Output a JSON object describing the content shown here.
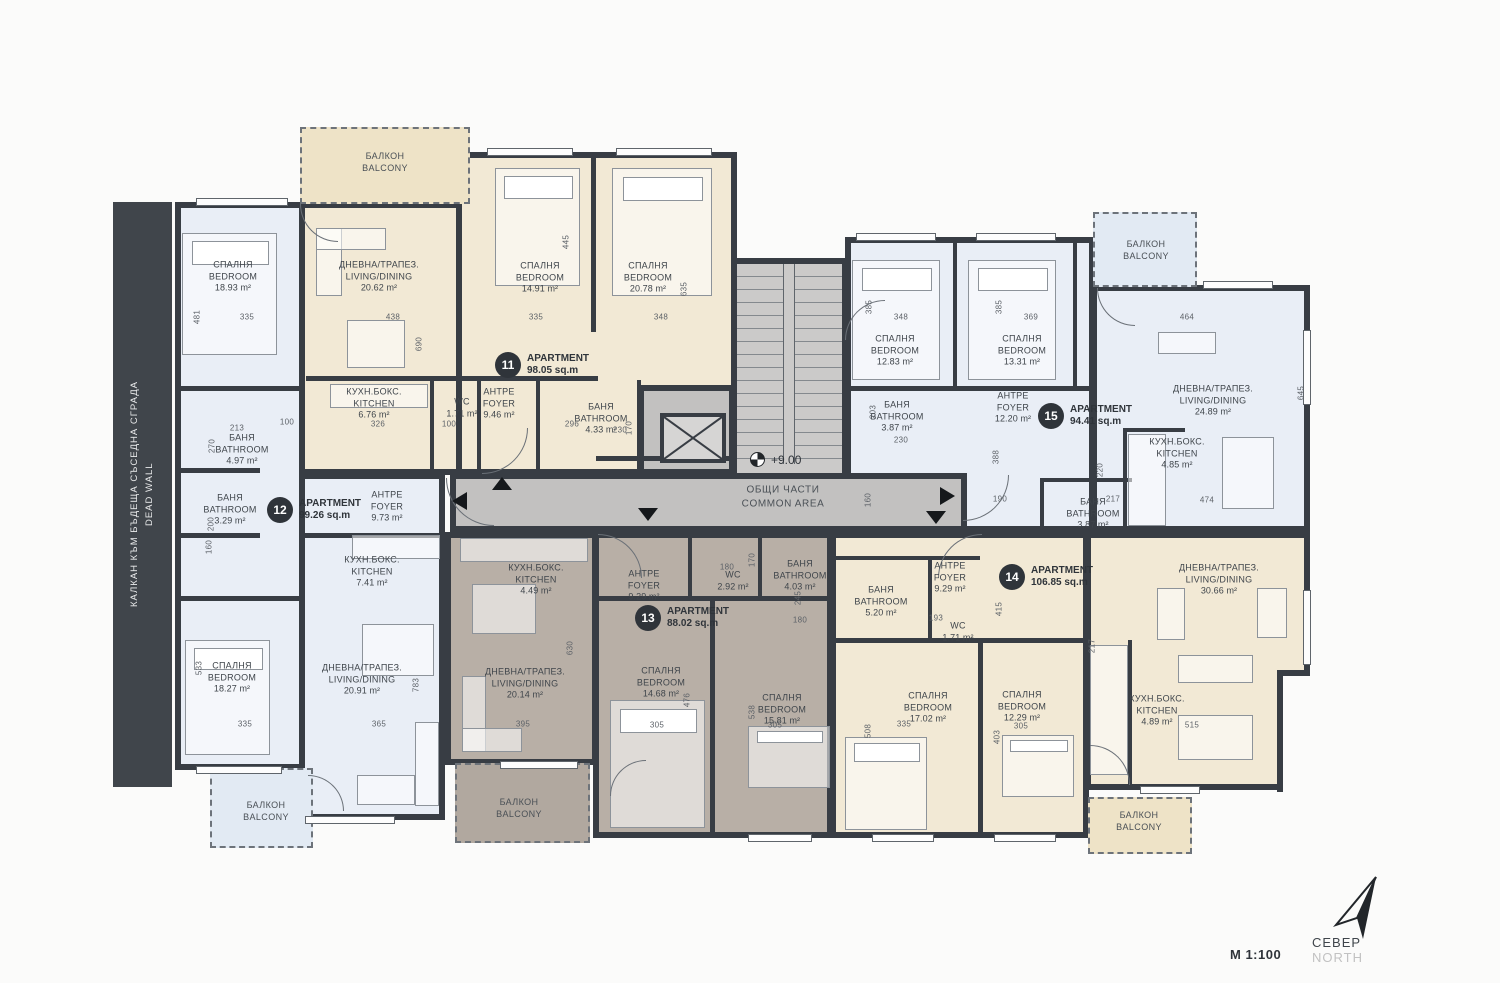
{
  "plan": {
    "scale": "М 1:100",
    "north": {
      "bg": "СЕВЕР",
      "en": "NORTH"
    },
    "level_mark": "+9.00",
    "dead_wall": {
      "bg": "КАЛКАН КЪМ БЪДЕЩА СЪСЕДНА СГРАДА",
      "en": "DEAD WALL"
    },
    "common_area": {
      "bg": "ОБЩИ ЧАСТИ",
      "en": "COMMON AREA"
    }
  },
  "balcony_label": {
    "bg": "БАЛКОН",
    "en": "BALCONY"
  },
  "apartments": [
    {
      "number": "11",
      "title": "APARTMENT",
      "area": "98.05 sq.m",
      "x": 508,
      "y": 365
    },
    {
      "number": "12",
      "title": "APARTMENT",
      "area": "99.26 sq.m",
      "x": 280,
      "y": 510
    },
    {
      "number": "13",
      "title": "APARTMENT",
      "area": "88.02 sq.m",
      "x": 648,
      "y": 618
    },
    {
      "number": "14",
      "title": "APARTMENT",
      "area": "106.85 sq.m",
      "x": 1012,
      "y": 577
    },
    {
      "number": "15",
      "title": "APARTMENT",
      "area": "94.41 sq.m",
      "x": 1051,
      "y": 416
    }
  ],
  "rooms": [
    {
      "apt": "12",
      "bg": "СПАЛНЯ",
      "en": "BEDROOM",
      "area": "18.93 m²",
      "x": 233,
      "y": 277
    },
    {
      "apt": "12",
      "bg": "БАНЯ",
      "en": "BATHROOM",
      "area": "4.97 m²",
      "x": 242,
      "y": 450
    },
    {
      "apt": "12",
      "bg": "БАНЯ",
      "en": "BATHROOM",
      "area": "3.29 m²",
      "x": 230,
      "y": 510
    },
    {
      "apt": "12",
      "bg": "АНТРЕ",
      "en": "FOYER",
      "area": "9.73 m²",
      "x": 387,
      "y": 507
    },
    {
      "apt": "12",
      "bg": "КУХН.БОКС.",
      "en": "KITCHEN",
      "area": "7.41 m²",
      "x": 372,
      "y": 572
    },
    {
      "apt": "12",
      "bg": "ДНЕВНА/ТРАПЕЗ.",
      "en": "LIVING/DINING",
      "area": "20.91 m²",
      "x": 362,
      "y": 680
    },
    {
      "apt": "12",
      "bg": "СПАЛНЯ",
      "en": "BEDROOM",
      "area": "18.27 m²",
      "x": 232,
      "y": 678
    },
    {
      "apt": "11",
      "bg": "ДНЕВНА/ТРАПЕЗ.",
      "en": "LIVING/DINING",
      "area": "20.62 m²",
      "x": 379,
      "y": 277
    },
    {
      "apt": "11",
      "bg": "СПАЛНЯ",
      "en": "BEDROOM",
      "area": "14.91 m²",
      "x": 540,
      "y": 278
    },
    {
      "apt": "11",
      "bg": "СПАЛНЯ",
      "en": "BEDROOM",
      "area": "20.78 m²",
      "x": 648,
      "y": 278
    },
    {
      "apt": "11",
      "bg": "КУХН.БОКС.",
      "en": "KITCHEN",
      "area": "6.76 m²",
      "x": 374,
      "y": 404
    },
    {
      "apt": "11",
      "bg": "WC",
      "en": "",
      "area": "1.71 m²",
      "x": 462,
      "y": 408
    },
    {
      "apt": "11",
      "bg": "АНТРЕ",
      "en": "FOYER",
      "area": "9.46 m²",
      "x": 499,
      "y": 404
    },
    {
      "apt": "11",
      "bg": "БАНЯ",
      "en": "BATHROOM",
      "area": "4.33 m²",
      "x": 601,
      "y": 419
    },
    {
      "apt": "13",
      "bg": "КУХН.БОКС.",
      "en": "KITCHEN",
      "area": "4.49 m²",
      "x": 536,
      "y": 580
    },
    {
      "apt": "13",
      "bg": "АНТРЕ",
      "en": "FOYER",
      "area": "9.29 m²",
      "x": 644,
      "y": 586
    },
    {
      "apt": "13",
      "bg": "WC",
      "en": "",
      "area": "2.92 m²",
      "x": 733,
      "y": 581
    },
    {
      "apt": "13",
      "bg": "БАНЯ",
      "en": "BATHROOM",
      "area": "4.03 m²",
      "x": 800,
      "y": 576
    },
    {
      "apt": "13",
      "bg": "ДНЕВНА/ТРАПЕЗ.",
      "en": "LIVING/DINING",
      "area": "20.14 m²",
      "x": 525,
      "y": 684
    },
    {
      "apt": "13",
      "bg": "СПАЛНЯ",
      "en": "BEDROOM",
      "area": "14.68 m²",
      "x": 661,
      "y": 683
    },
    {
      "apt": "13",
      "bg": "СПАЛНЯ",
      "en": "BEDROOM",
      "area": "15.81 m²",
      "x": 782,
      "y": 710
    },
    {
      "apt": "14",
      "bg": "АНТРЕ",
      "en": "FOYER",
      "area": "9.29 m²",
      "x": 950,
      "y": 578
    },
    {
      "apt": "14",
      "bg": "БАНЯ",
      "en": "BATHROOM",
      "area": "5.20 m²",
      "x": 881,
      "y": 602
    },
    {
      "apt": "14",
      "bg": "WC",
      "en": "",
      "area": "1.71 m²",
      "x": 958,
      "y": 632
    },
    {
      "apt": "14",
      "bg": "СПАЛНЯ",
      "en": "BEDROOM",
      "area": "17.02 m²",
      "x": 928,
      "y": 708
    },
    {
      "apt": "14",
      "bg": "СПАЛНЯ",
      "en": "BEDROOM",
      "area": "12.29 m²",
      "x": 1022,
      "y": 707
    },
    {
      "apt": "14",
      "bg": "КУХН.БОКС.",
      "en": "KITCHEN",
      "area": "4.89 m²",
      "x": 1157,
      "y": 711
    },
    {
      "apt": "14",
      "bg": "ДНЕВНА/ТРАПЕЗ.",
      "en": "LIVING/DINING",
      "area": "30.66 m²",
      "x": 1219,
      "y": 580
    },
    {
      "apt": "15",
      "bg": "СПАЛНЯ",
      "en": "BEDROOM",
      "area": "12.83 m²",
      "x": 895,
      "y": 351
    },
    {
      "apt": "15",
      "bg": "СПАЛНЯ",
      "en": "BEDROOM",
      "area": "13.31 m²",
      "x": 1022,
      "y": 351
    },
    {
      "apt": "15",
      "bg": "БАНЯ",
      "en": "BATHROOM",
      "area": "3.87 m²",
      "x": 897,
      "y": 417
    },
    {
      "apt": "15",
      "bg": "АНТРЕ",
      "en": "FOYER",
      "area": "12.20 m²",
      "x": 1013,
      "y": 408
    },
    {
      "apt": "15",
      "bg": "ДНЕВНА/ТРАПЕЗ.",
      "en": "LIVING/DINING",
      "area": "24.89 m²",
      "x": 1213,
      "y": 401
    },
    {
      "apt": "15",
      "bg": "КУХН.БОКС.",
      "en": "KITCHEN",
      "area": "4.85 m²",
      "x": 1177,
      "y": 454
    },
    {
      "apt": "15",
      "bg": "БАНЯ",
      "en": "BATHROOM",
      "area": "3.87 m²",
      "x": 1093,
      "y": 514
    }
  ],
  "balconies": [
    {
      "x": 385,
      "y": 162
    },
    {
      "x": 1146,
      "y": 250
    },
    {
      "x": 266,
      "y": 811
    },
    {
      "x": 519,
      "y": 808
    },
    {
      "x": 1139,
      "y": 821
    }
  ],
  "dimensions": [
    {
      "t": "481",
      "x": 197,
      "y": 317,
      "r": 1
    },
    {
      "t": "335",
      "x": 247,
      "y": 317,
      "r": 0
    },
    {
      "t": "438",
      "x": 393,
      "y": 317,
      "r": 0
    },
    {
      "t": "690",
      "x": 419,
      "y": 344,
      "r": 1
    },
    {
      "t": "445",
      "x": 566,
      "y": 242,
      "r": 1
    },
    {
      "t": "335",
      "x": 536,
      "y": 317,
      "r": 0
    },
    {
      "t": "348",
      "x": 661,
      "y": 317,
      "r": 0
    },
    {
      "t": "635",
      "x": 684,
      "y": 289,
      "r": 1
    },
    {
      "t": "348",
      "x": 901,
      "y": 317,
      "r": 0
    },
    {
      "t": "385",
      "x": 869,
      "y": 307,
      "r": 1
    },
    {
      "t": "369",
      "x": 1031,
      "y": 317,
      "r": 0
    },
    {
      "t": "385",
      "x": 999,
      "y": 307,
      "r": 1
    },
    {
      "t": "464",
      "x": 1187,
      "y": 317,
      "r": 0
    },
    {
      "t": "645",
      "x": 1301,
      "y": 393,
      "r": 1
    },
    {
      "t": "213",
      "x": 237,
      "y": 428,
      "r": 0
    },
    {
      "t": "100",
      "x": 287,
      "y": 422,
      "r": 0
    },
    {
      "t": "270",
      "x": 212,
      "y": 446,
      "r": 1
    },
    {
      "t": "326",
      "x": 378,
      "y": 424,
      "r": 0
    },
    {
      "t": "100",
      "x": 449,
      "y": 424,
      "r": 0
    },
    {
      "t": "296",
      "x": 572,
      "y": 424,
      "r": 0
    },
    {
      "t": "170",
      "x": 629,
      "y": 428,
      "r": 1
    },
    {
      "t": "200",
      "x": 211,
      "y": 524,
      "r": 1
    },
    {
      "t": "160",
      "x": 209,
      "y": 547,
      "r": 1
    },
    {
      "t": "533",
      "x": 199,
      "y": 668,
      "r": 1
    },
    {
      "t": "783",
      "x": 416,
      "y": 685,
      "r": 1
    },
    {
      "t": "335",
      "x": 245,
      "y": 724,
      "r": 0
    },
    {
      "t": "365",
      "x": 379,
      "y": 724,
      "r": 0
    },
    {
      "t": "630",
      "x": 570,
      "y": 648,
      "r": 1
    },
    {
      "t": "395",
      "x": 523,
      "y": 724,
      "r": 0
    },
    {
      "t": "305",
      "x": 657,
      "y": 725,
      "r": 0
    },
    {
      "t": "476",
      "x": 687,
      "y": 700,
      "r": 1
    },
    {
      "t": "538",
      "x": 752,
      "y": 712,
      "r": 1
    },
    {
      "t": "305",
      "x": 775,
      "y": 725,
      "r": 0
    },
    {
      "t": "180",
      "x": 727,
      "y": 567,
      "r": 0
    },
    {
      "t": "170",
      "x": 752,
      "y": 560,
      "r": 1
    },
    {
      "t": "245",
      "x": 798,
      "y": 598,
      "r": 1
    },
    {
      "t": "180",
      "x": 800,
      "y": 620,
      "r": 0
    },
    {
      "t": "160",
      "x": 868,
      "y": 500,
      "r": 1
    },
    {
      "t": "190",
      "x": 1000,
      "y": 499,
      "r": 0
    },
    {
      "t": "230",
      "x": 901,
      "y": 440,
      "r": 0
    },
    {
      "t": "388",
      "x": 996,
      "y": 457,
      "r": 1
    },
    {
      "t": "203",
      "x": 873,
      "y": 412,
      "r": 1
    },
    {
      "t": "474",
      "x": 1207,
      "y": 500,
      "r": 0
    },
    {
      "t": "335",
      "x": 904,
      "y": 724,
      "r": 0
    },
    {
      "t": "305",
      "x": 1021,
      "y": 726,
      "r": 0
    },
    {
      "t": "508",
      "x": 868,
      "y": 731,
      "r": 1
    },
    {
      "t": "403",
      "x": 997,
      "y": 737,
      "r": 1
    },
    {
      "t": "415",
      "x": 999,
      "y": 609,
      "r": 1
    },
    {
      "t": "217",
      "x": 1092,
      "y": 646,
      "r": 1
    },
    {
      "t": "515",
      "x": 1192,
      "y": 725,
      "r": 0
    },
    {
      "t": "193",
      "x": 936,
      "y": 618,
      "r": 0
    },
    {
      "t": "230",
      "x": 620,
      "y": 430,
      "r": 0
    },
    {
      "t": "220",
      "x": 1100,
      "y": 470,
      "r": 1
    },
    {
      "t": "217",
      "x": 1113,
      "y": 499,
      "r": 0
    }
  ],
  "colors": {
    "wall": "#383d44",
    "ap11": "#f2e9d5",
    "ap12": "#e9eef6",
    "ap13": "#b8afa6",
    "ap14": "#f2e9d5",
    "ap15": "#e9eef6",
    "common": "#c2c1c0"
  }
}
